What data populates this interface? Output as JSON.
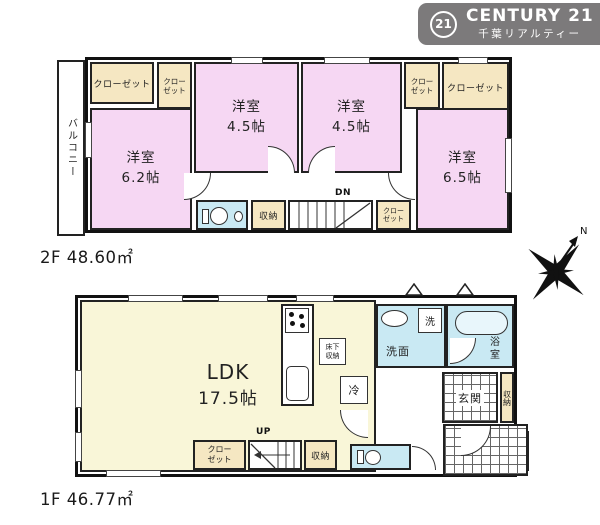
{
  "logo": {
    "circle_text": "21",
    "brand": "CENTURY 21",
    "subtitle": "千葉リアルティー",
    "bg_color": "#7c7a7b"
  },
  "compass": {
    "north_label": "N"
  },
  "colors": {
    "room_pink": "#f6d7f3",
    "closet_cream": "#f5e7c2",
    "ldk_yellow": "#f9f6d8",
    "wet_area_blue": "#c9e9f3",
    "wall_black": "#111111"
  },
  "floor2": {
    "area_label": "2F 48.60㎡",
    "balcony_label": "バルコニー",
    "closet_top_left": "クローゼット",
    "closet_small_left_l1": "クロー",
    "closet_small_left_l2": "ゼット",
    "room_62_name": "洋室",
    "room_62_size": "6.2帖",
    "room_45a_name": "洋室",
    "room_45a_size": "4.5帖",
    "room_45b_name": "洋室",
    "room_45b_size": "4.5帖",
    "closet_small_right_l1": "クロー",
    "closet_small_right_l2": "ゼット",
    "closet_top_right": "クローゼット",
    "room_65_name": "洋室",
    "room_65_size": "6.5帖",
    "storage_label": "収納",
    "stairs_label": "DN",
    "closet_hall_l1": "クロー",
    "closet_hall_l2": "ゼット"
  },
  "floor1": {
    "area_label": "1F 46.77㎡",
    "ldk_name": "LDK",
    "ldk_size": "17.5帖",
    "floor_storage_l1": "床下",
    "floor_storage_l2": "収納",
    "fridge_label": "冷",
    "stairs_label": "UP",
    "closet_l1": "クロー",
    "closet_l2": "ゼット",
    "storage_label": "収納",
    "washer_label": "洗",
    "washroom_label": "洗面",
    "bath_l1": "浴",
    "bath_l2": "室",
    "entrance_label": "玄関",
    "entrance_storage": "収納"
  }
}
